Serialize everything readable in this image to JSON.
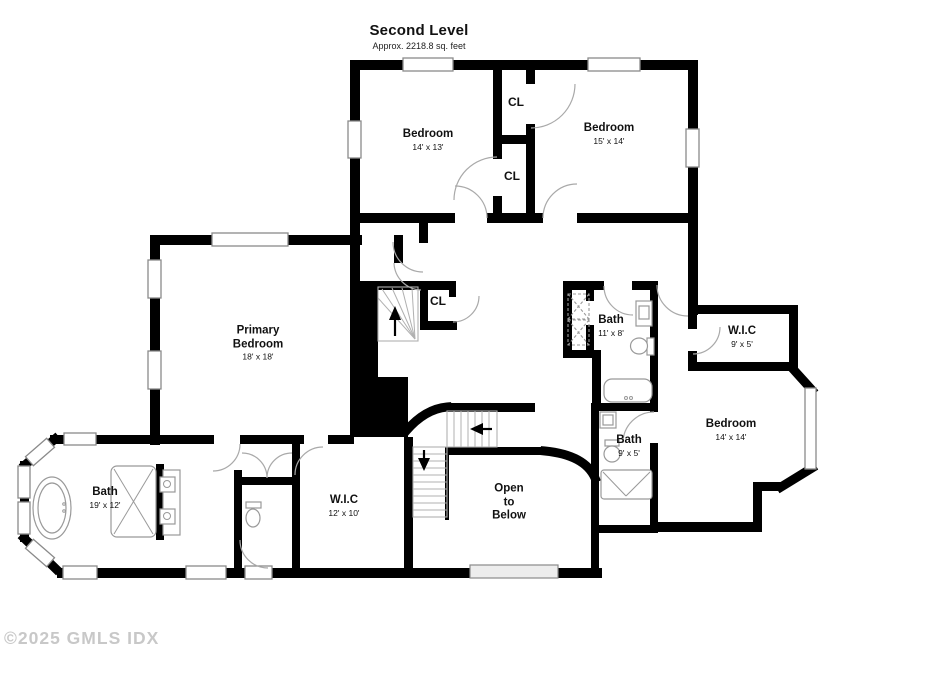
{
  "title": {
    "heading": "Second Level",
    "subheading": "Approx. 2218.8 sq. feet"
  },
  "watermark": "©2025 GMLS IDX",
  "rooms": [
    {
      "id": "bedroom-top-left",
      "name_lines": [
        "Bedroom"
      ],
      "dims": "14' x 13'",
      "cx": 428,
      "cy": 140
    },
    {
      "id": "bedroom-top-right",
      "name_lines": [
        "Bedroom"
      ],
      "dims": "15' x 14'",
      "cx": 609,
      "cy": 134
    },
    {
      "id": "closet-upper",
      "name_lines": [
        "CL"
      ],
      "dims": "",
      "cx": 516,
      "cy": 102,
      "small": true
    },
    {
      "id": "closet-lower",
      "name_lines": [
        "CL"
      ],
      "dims": "",
      "cx": 512,
      "cy": 176,
      "small": true
    },
    {
      "id": "closet-stairs",
      "name_lines": [
        "CL"
      ],
      "dims": "",
      "cx": 438,
      "cy": 301,
      "small": true
    },
    {
      "id": "primary-bedroom",
      "name_lines": [
        "Primary",
        "Bedroom"
      ],
      "dims": "18' x 18'",
      "cx": 258,
      "cy": 343
    },
    {
      "id": "primary-bath",
      "name_lines": [
        "Bath"
      ],
      "dims": "19' x 12'",
      "cx": 105,
      "cy": 498
    },
    {
      "id": "primary-wic",
      "name_lines": [
        "W.I.C"
      ],
      "dims": "12' x 10'",
      "cx": 344,
      "cy": 506
    },
    {
      "id": "open-to-below",
      "name_lines": [
        "Open",
        "to",
        "Below"
      ],
      "dims": "",
      "cx": 509,
      "cy": 503
    },
    {
      "id": "hall-bath",
      "name_lines": [
        "Bath"
      ],
      "dims": "11' x 8'",
      "cx": 611,
      "cy": 326
    },
    {
      "id": "wic-second",
      "name_lines": [
        "W.I.C"
      ],
      "dims": "9' x 5'",
      "cx": 742,
      "cy": 337
    },
    {
      "id": "bedroom-right",
      "name_lines": [
        "Bedroom"
      ],
      "dims": "14' x 14'",
      "cx": 731,
      "cy": 430
    },
    {
      "id": "small-bath",
      "name_lines": [
        "Bath"
      ],
      "dims": "9' x 5'",
      "cx": 629,
      "cy": 446
    }
  ],
  "stair_arrows": {
    "up": "↑",
    "down": "↓",
    "left": "←"
  },
  "colors": {
    "wall": "#000000",
    "window_border": "#8a8a8a",
    "door": "#a9a9a9",
    "fixture": "#999999",
    "tread": "#b0b0b0",
    "label": "#111111",
    "watermark": "#c8c8c8",
    "bg": "#ffffff",
    "railing": "#ededed"
  }
}
